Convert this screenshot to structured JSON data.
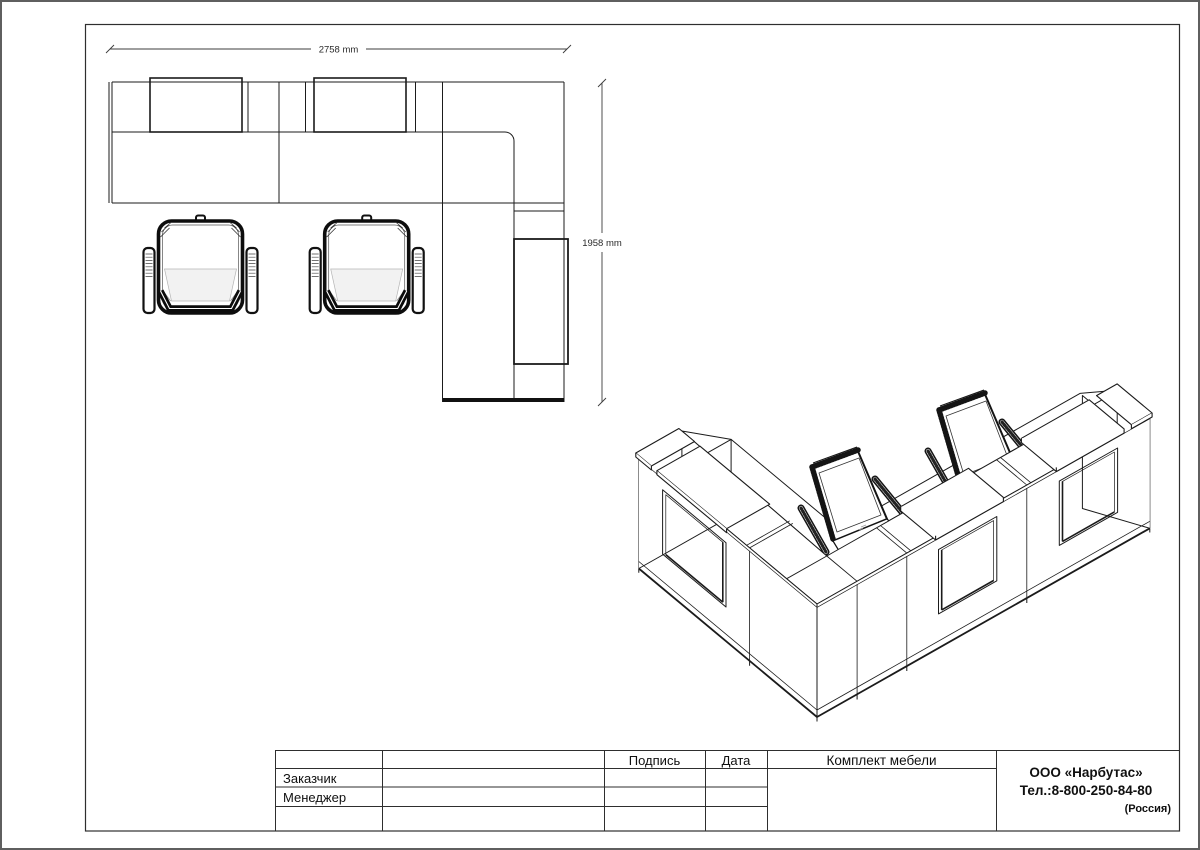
{
  "plan": {
    "dim_width": "2758 mm",
    "dim_height": "1958 mm"
  },
  "title_block": {
    "signature_header": "Подпись",
    "date_header": "Дата",
    "customer_label": "Заказчик",
    "manager_label": "Менеджер",
    "set_title": "Комплект мебели",
    "company_name": "ООО «Нарбутас»",
    "company_phone": "Тел.:8-800-250-84-80",
    "company_country": "(Россия)"
  }
}
